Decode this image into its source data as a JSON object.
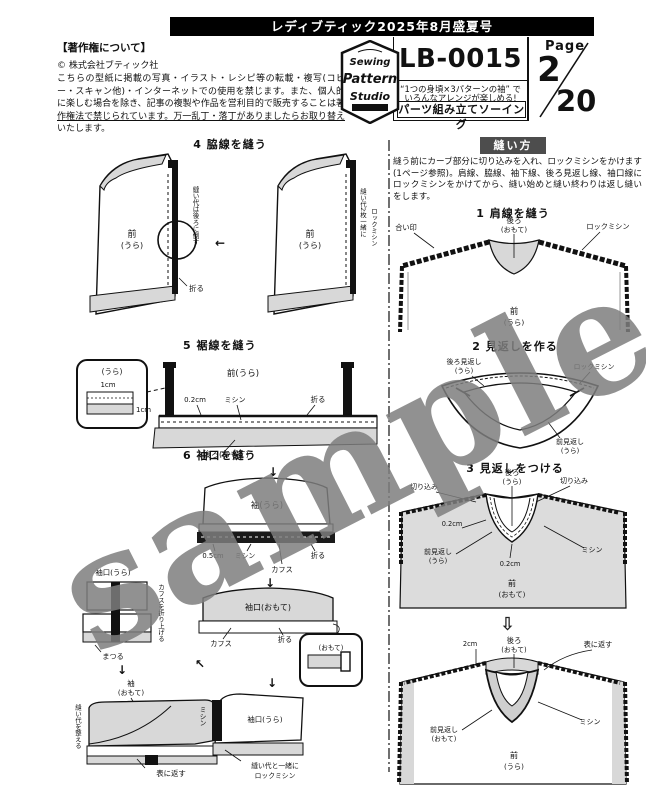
{
  "banner": {
    "title": "レディブティック2025年8月盛夏号"
  },
  "copyright": {
    "heading": "【著作権について】",
    "company": "© 株式会社ブティック社",
    "body": "こちらの型紙に掲載の写真・イラスト・レシピ等の転載・複写(コピー・スキャン他)・インターネットでの使用を禁じます。また、個人的に楽しむ場合を除き、記事の複製や作品を営利目的で販売することは著作権法で禁じられています。万一乱丁・落丁がありましたらお取り替えいたします。"
  },
  "logo": {
    "word1": "Sewing",
    "word2": "Pattern",
    "word3": "Studio"
  },
  "pattern": {
    "code": "LB-0015",
    "tagline1": "“1つの身頃×3パターンの袖” で",
    "tagline2": "いろんなアレンジが楽しめる!",
    "tagline3": "パーツ組み立てソーイング"
  },
  "page": {
    "label": "Page",
    "current": "2",
    "total": "20"
  },
  "watermark": {
    "text": "sample"
  },
  "howto": {
    "header": "縫い方",
    "intro": "縫う前にカーブ部分に切り込みを入れ、ロックミシンをかけます(1ページ参照)。肩線、脇線、袖下線、後ろ見返し線、袖口線にロックミシンをかけてから、縫い始めと縫い終わりは返し縫いをします。"
  },
  "s1": {
    "title": "1 肩線を縫う",
    "back1": "後ろ",
    "back2": "(おもて)",
    "mark": "合い印",
    "lock": "ロックミシン",
    "front1": "前",
    "front2": "(うら)"
  },
  "s2": {
    "title": "2 見返しを作る",
    "backfacing1": "後ろ見返し",
    "backfacing2": "(うら)",
    "lock": "ロックミシン",
    "frontfacing1": "前見返し",
    "frontfacing2": "(うら)"
  },
  "s3": {
    "title": "3 見返しをつける",
    "a_back1": "後ろ",
    "a_back2": "(うら)",
    "clip_left": "切り込み",
    "clip_right": "切り込み",
    "a_02a": "0.2cm",
    "a_facing1": "前見返し",
    "a_facing2": "(うら)",
    "a_02b": "0.2cm",
    "a_stitch": "ミシン",
    "a_front1": "前",
    "a_front2": "(おもて)",
    "arrow_down": "⇩",
    "b_2cm": "2cm",
    "b_back1": "後ろ",
    "b_back2": "(おもて)",
    "b_turn": "表に返す",
    "b_facing1": "前見返し",
    "b_facing2": "(おもて)",
    "b_stitch": "ミシン",
    "b_front1": "前",
    "b_front2": "(うら)"
  },
  "d4": {
    "title": "4 脇線を縫う",
    "a_front1": "前",
    "a_front2": "(うら)",
    "a_side": "縫い代は後ろに倒す",
    "a_fold": "折る",
    "arrow_left": "←",
    "b_front1": "前",
    "b_front2": "(うら)",
    "b_lock1": "縫い代2枚一緒に",
    "b_lock2": "ロックミシン"
  },
  "d5": {
    "title": "5 裾線を縫う",
    "inset_side": "(うら)",
    "inset_1cm_a": "1cm",
    "inset_1cm_b": "1cm",
    "front": "前(うら)",
    "cm02": "0.2cm",
    "stitch": "ミシン",
    "fold": "折る",
    "back": "後ろ(おもて)"
  },
  "d6": {
    "title": "6 袖口を縫う",
    "arrow0": "↓",
    "sleeve": "袖(うら)",
    "cm05": "0.5cm",
    "stitch1": "ミシン",
    "cuff1": "カフス",
    "fold1": "折る",
    "arrow1": "↓",
    "cuff_front": "袖口(おもて)",
    "cuff2": "カフス",
    "fold2": "折る",
    "inset_front": "(おもて)",
    "arrow_nw": "↖",
    "arrow2": "↓",
    "cuff_back_label": "袖口(うら)",
    "v_fold": "カフスを折り上げる",
    "hem_stitch": "まつる",
    "arrow3": "↓",
    "sleeve_front1": "袖",
    "sleeve_front2": "(おもて)",
    "v_left": "縫い代を整える",
    "turn": "表に返す",
    "cuff_c": "袖口(うら)",
    "v_stitch": "ミシン",
    "lock1": "縫い代と一緒に",
    "lock2": "ロックミシン"
  }
}
